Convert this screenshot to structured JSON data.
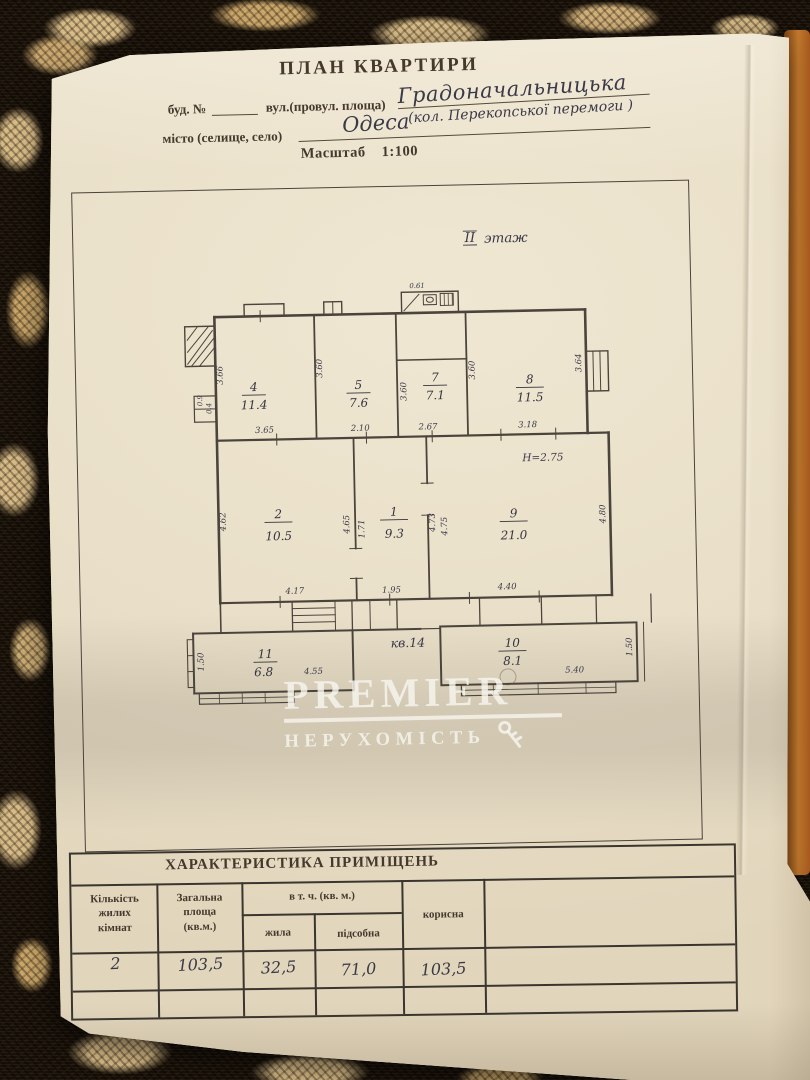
{
  "colors": {
    "paper": "#e8decb",
    "plan_ink": "#4b443c",
    "print_ink": "#44392d",
    "hand_ink": "#3a3947",
    "carpet_black": "#171008",
    "carpet_tan": "#d7ba85",
    "strip_orange": "#b06023",
    "watermark_white": "#f5f2ea"
  },
  "header": {
    "title": "ПЛАН КВАРТИРИ",
    "building_label": "буд. №",
    "street_label": "вул.(провул. площа)",
    "street_value": "Градоначальницька",
    "street_former": "(кол. Перекопської перемоги )",
    "city_label": "місто (селище, село)",
    "city_value": "Одеса",
    "scale_label": "Масштаб",
    "scale_value": "1:100"
  },
  "plan": {
    "floor_roman": "II",
    "floor_word": "этаж",
    "apartment_label": "кв.14",
    "height_note": "Н=2.75",
    "rooms": [
      {
        "number": "4",
        "area": "11.4"
      },
      {
        "number": "5",
        "area": "7.6"
      },
      {
        "number": "7",
        "area": "7.1"
      },
      {
        "number": "8",
        "area": "11.5"
      },
      {
        "number": "2",
        "area": "10.5"
      },
      {
        "number": "1",
        "area": "9.3"
      },
      {
        "number": "9",
        "area": "21.0"
      },
      {
        "number": "11",
        "area": "6.8"
      },
      {
        "number": "10",
        "area": "8.1"
      }
    ],
    "dims": {
      "wc_top": "0.61",
      "r4_left": "3.66",
      "r4_bottom": "3.65",
      "r5_left": "3.60",
      "r5_bottom": "2.10",
      "r7_left": "3.60",
      "r7_bottom": "2.67",
      "r8_left": "3.60",
      "r8_right": "3.64",
      "r8_bottom": "3.18",
      "r2_left": "4.62",
      "r2_bottom": "4.17",
      "r1_left_a": "4.65",
      "r1_left_b": "1.71",
      "r1_bottom": "1.95",
      "r1_right_a": "4.73",
      "r1_right_b": "4.75",
      "r9_right": "4.80",
      "r9_bottom": "4.40",
      "r11_left": "1.50",
      "r11_bottom": "4.55",
      "r10_bottom": "5.40",
      "r10_right": "1.50",
      "niche_a": "0.9",
      "niche_b": "0.4"
    }
  },
  "watermark": {
    "brand": "PREMIER",
    "subtitle": "НЕРУХОМІСТЬ"
  },
  "table": {
    "title": "ХАРАКТЕРИСТИКА ПРИМІЩЕНЬ",
    "col_rooms": "Кількість\nжилих\nкімнат",
    "col_total": "Загальна\nплоща\n(кв.м.)",
    "col_incl": "в т. ч. (кв. м.)",
    "col_living": "жила",
    "col_utility": "підсобна",
    "col_useful": "корисна",
    "row": {
      "rooms": "2",
      "total": "103,5",
      "living": "32,5",
      "utility": "71,0",
      "useful": "103,5"
    }
  }
}
